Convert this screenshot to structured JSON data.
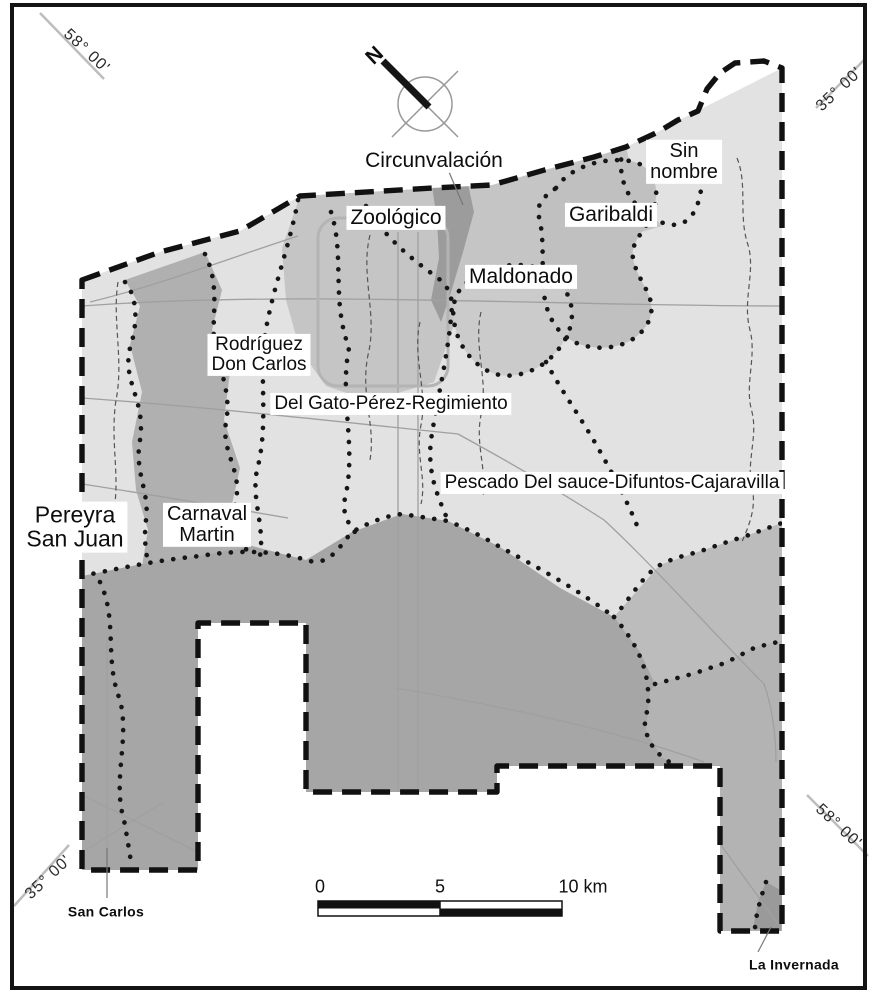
{
  "figure": {
    "type": "watershed-map",
    "north_label": "N",
    "corner_coordinates": {
      "top_left": "58° 00'",
      "top_right": "35° 00'",
      "bottom_left": "35° 00'",
      "bottom_right": "58° 00'"
    },
    "basin_labels": {
      "circunvalacion": "Circunvalación",
      "zoologico": "Zoológico",
      "sin_nombre": {
        "line1": "Sin",
        "line2": "nombre"
      },
      "garibaldi": "Garibaldi",
      "maldonado": "Maldonado",
      "rodriguez_don_carlos": {
        "line1": "Rodríguez",
        "line2": "Don Carlos"
      },
      "del_gato": "Del Gato-Pérez-Regimiento",
      "pescado": "Pescado Del sauce-Difuntos-Cajaravilla",
      "pereyra_san_juan": {
        "line1": "Pereyra",
        "line2": "San Juan"
      },
      "carnaval_martin": {
        "line1": "Carnaval",
        "line2": "Martin"
      }
    },
    "place_labels": {
      "san_carlos": "San Carlos",
      "la_invernada": "La Invernada"
    },
    "scale_bar": {
      "tick_0": "0",
      "tick_5": "5",
      "tick_10": "10 km"
    },
    "colors": {
      "background": "#ffffff",
      "frame": "#141414",
      "boundary": "#111111",
      "light_basin": "#e2e2e2",
      "medium_basin": "#c5c5c5",
      "dark_basin": "#a6a6a6",
      "darkest_strip": "#9c9c9c"
    }
  }
}
